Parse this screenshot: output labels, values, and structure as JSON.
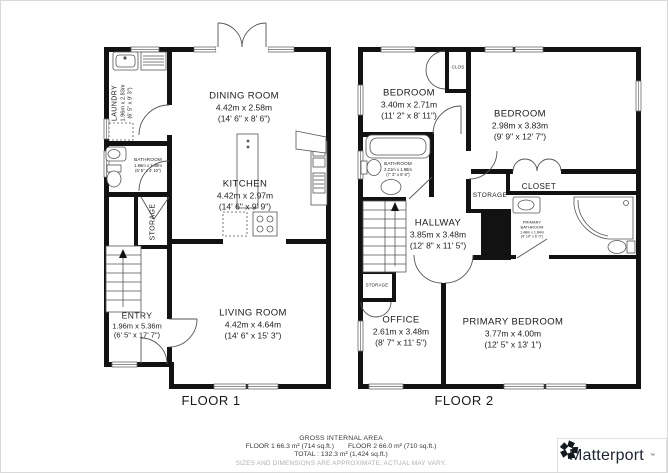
{
  "colors": {
    "wall": "#121212",
    "thin_line": "#555555",
    "text": "#1c1c1c",
    "muted_text": "#b0b0b0",
    "brand_text": "#1e2430"
  },
  "floor1": {
    "label": "FLOOR 1",
    "rooms": {
      "laundry": {
        "name": "LAUNDRY",
        "metric": "1.96m x 2.83m",
        "imperial": "(6' 5\" x 9' 3\")"
      },
      "dining_room": {
        "name": "DINING ROOM",
        "metric": "4.42m x 2.58m",
        "imperial": "(14' 6\" x 8' 6\")"
      },
      "bathroom": {
        "name": "BATHROOM",
        "metric": "1.96m x 1.49m",
        "imperial": "(6' 5\" x 4' 10\")"
      },
      "kitchen": {
        "name": "KITCHEN",
        "metric": "4.42m x 2.97m",
        "imperial": "(14' 6\" x 9' 9\")"
      },
      "storage": {
        "name": "STORAGE"
      },
      "entry": {
        "name": "ENTRY",
        "metric": "1.96m x 5.36m",
        "imperial": "(6' 5\" x 17' 7\")"
      },
      "living_room": {
        "name": "LIVING ROOM",
        "metric": "4.42m x 4.64m",
        "imperial": "(14' 6\" x 15' 3\")"
      }
    }
  },
  "floor2": {
    "label": "FLOOR 2",
    "rooms": {
      "bedroom_left": {
        "name": "BEDROOM",
        "metric": "3.40m x 2.71m",
        "imperial": "(11' 2\" x 8' 11\")"
      },
      "bedroom_right": {
        "name": "BEDROOM",
        "metric": "2.98m x 3.83m",
        "imperial": "(9' 9\" x 12' 7\")"
      },
      "clos": {
        "name": "CLOS"
      },
      "bathroom": {
        "name": "BATHROOM",
        "metric": "2.21m x 1.98m",
        "imperial": "(7' 3\" x 6' 6\")"
      },
      "closet": {
        "name": "CLOSET"
      },
      "storage_upper": {
        "name": "STORAGE"
      },
      "hallway": {
        "name": "HALLWAY",
        "metric": "3.85m x 3.48m",
        "imperial": "(12' 8\" x 11' 5\")"
      },
      "primary_bathroom": {
        "name": "PRIMARY BATHROOM",
        "metric": "1.48m x 1.84m",
        "imperial": "(4' 10\" x 6' 0\")"
      },
      "storage_lower": {
        "name": "STORAGE"
      },
      "office": {
        "name": "OFFICE",
        "metric": "2.61m x 3.48m",
        "imperial": "(8' 7\" x 11' 5\")"
      },
      "primary_bedroom": {
        "name": "PRIMARY BEDROOM",
        "metric": "3.77m x 4.00m",
        "imperial": "(12' 5\" x 13' 1\")"
      }
    }
  },
  "footer": {
    "title": "GROSS INTERNAL AREA",
    "floor1_area": "FLOOR 1 66.3 m² (714 sq.ft.)",
    "floor2_area": "FLOOR 2 66.0 m² (710 sq.ft.)",
    "total": "TOTAL :  132.3 m² (1,424 sq.ft.)",
    "disclaimer": "SIZES AND DIMENSIONS ARE APPROXIMATE, ACTUAL MAY VARY."
  },
  "brand": {
    "name": "Matterport",
    "mark": "™"
  }
}
